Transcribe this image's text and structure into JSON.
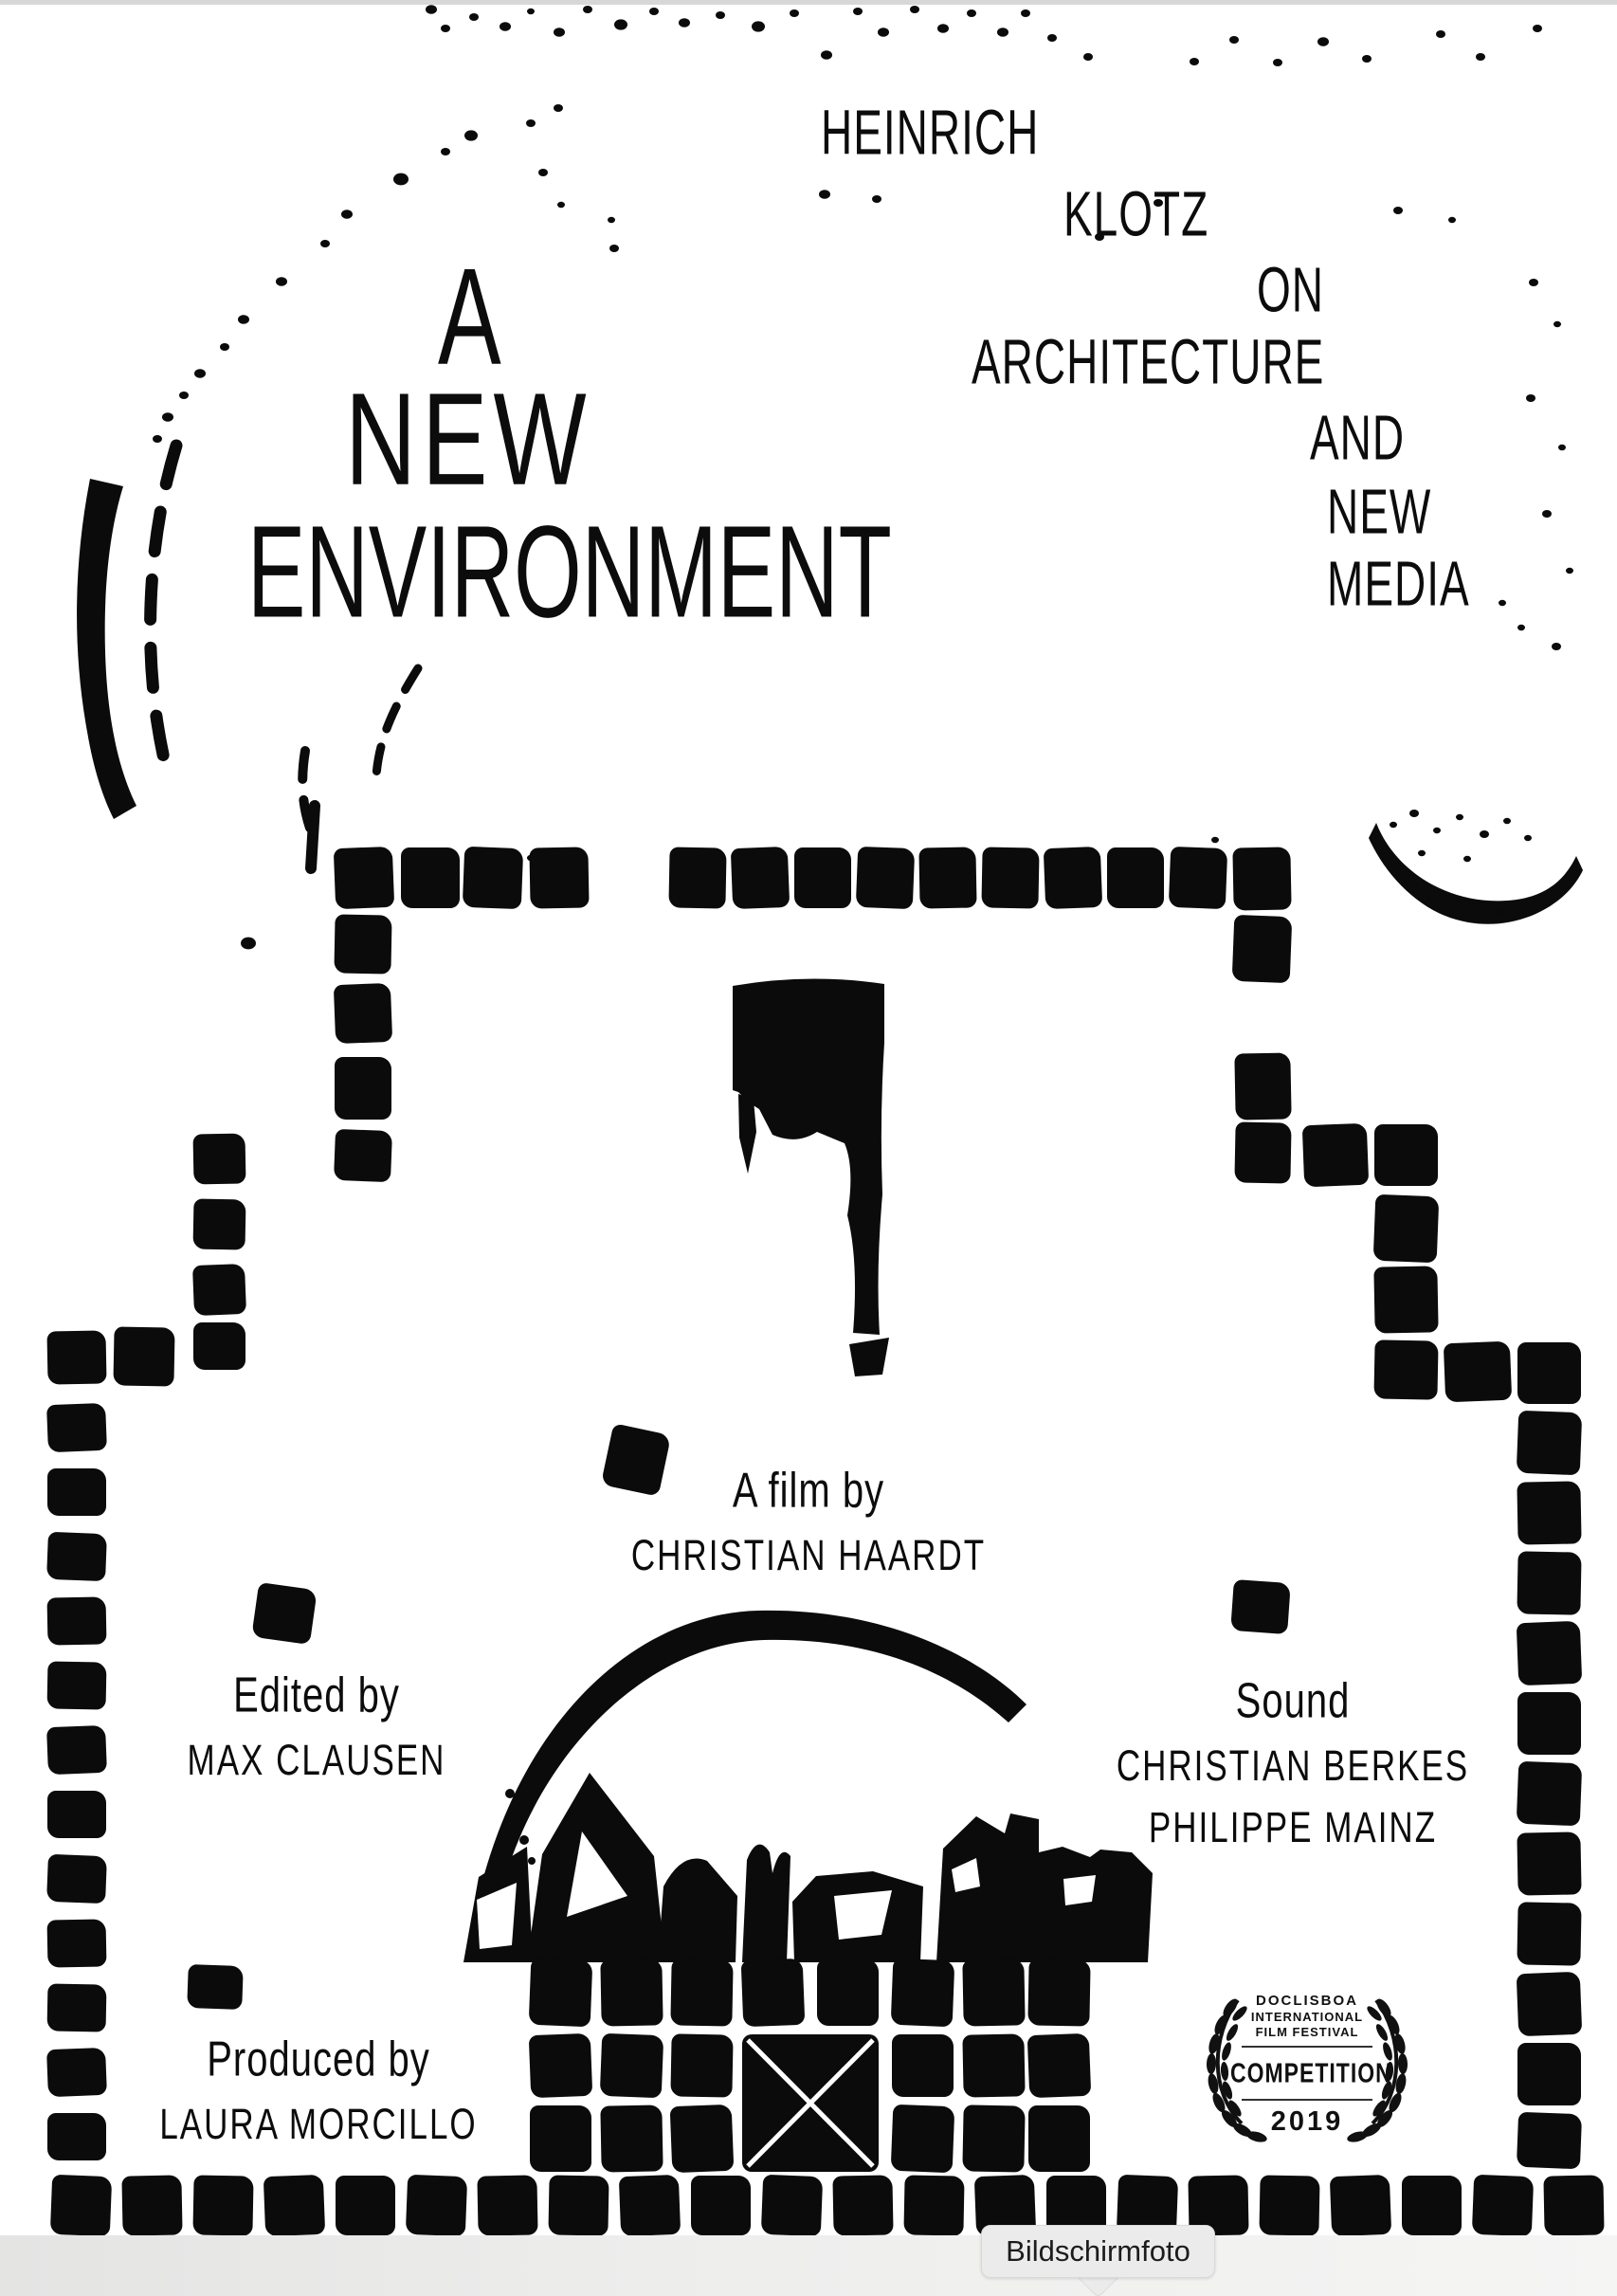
{
  "poster": {
    "title": {
      "line1": "A",
      "line2": "NEW",
      "line3": "ENVIRONMENT"
    },
    "subtitle": {
      "words": [
        "HEINRICH",
        "KLOTZ",
        "ON",
        "ARCHITECTURE",
        "AND",
        "NEW",
        "MEDIA"
      ]
    },
    "credits": {
      "film_by_label": "A film by",
      "film_by_name": "CHRISTIAN HAARDT",
      "edited_label": "Edited by",
      "edited_name": "MAX CLAUSEN",
      "sound_label": "Sound",
      "sound_name_1": "CHRISTIAN BERKES",
      "sound_name_2": "PHILIPPE MAINZ",
      "produced_label": "Produced by",
      "produced_name": "LAURA MORCILLO"
    },
    "festival_badge": {
      "festival_line_1": "DOCLISBOA",
      "festival_line_2": "INTERNATIONAL",
      "festival_line_3": "FILM FESTIVAL",
      "award": "COMPETITION",
      "year": "2019",
      "icon": "laurel-wreath-icon"
    },
    "poster_credit": "Poster by www...",
    "colors": {
      "ink": "#0c0c0c",
      "paper": "#ffffff"
    }
  },
  "os": {
    "tooltip_label": "Bildschirmfoto"
  }
}
